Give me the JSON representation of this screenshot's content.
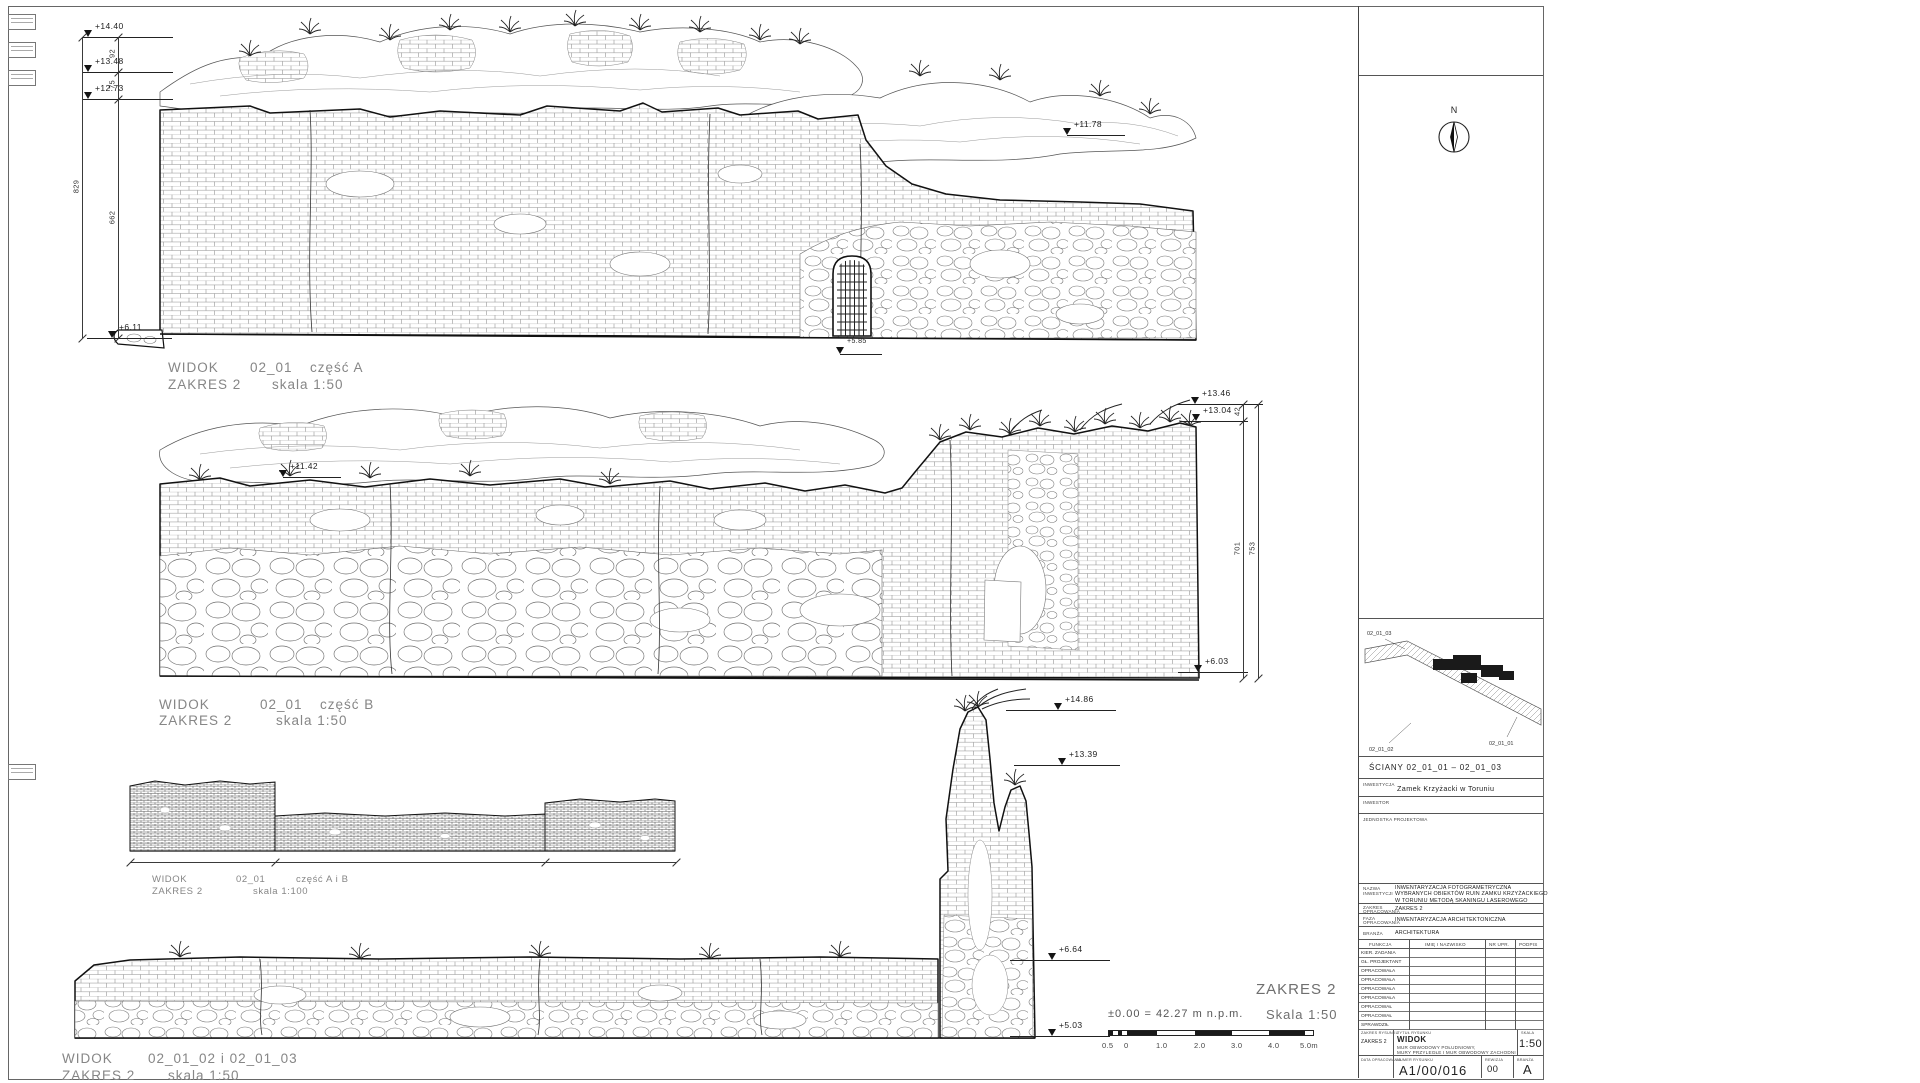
{
  "colors": {
    "ink": "#1f1f1f",
    "caption": "#868686",
    "dim": "#333333"
  },
  "captions": {
    "a": {
      "word": "WIDOK",
      "code": "02_01",
      "part": "część A",
      "zakres": "ZAKRES 2",
      "scale": "skala 1:50"
    },
    "b": {
      "word": "WIDOK",
      "code": "02_01",
      "part": "część B",
      "zakres": "ZAKRES 2",
      "scale": "skala 1:50"
    },
    "ab": {
      "word": "WIDOK",
      "code": "02_01",
      "part": "część A i B",
      "zakres": "ZAKRES 2",
      "scale": "skala 1:100"
    },
    "bottom": {
      "word": "WIDOK",
      "code": "02_01_02 i 02_01_03",
      "zakres": "ZAKRES 2",
      "scale": "skala 1:50"
    }
  },
  "markers": [
    {
      "label": "+14.40",
      "x": 88,
      "y": 37,
      "tail": 6,
      "len": 85
    },
    {
      "label": "+13.48",
      "x": 88,
      "y": 72,
      "tail": 6,
      "len": 85
    },
    {
      "label": "+12.73",
      "x": 88,
      "y": 99,
      "tail": 6,
      "len": 85
    },
    {
      "label": "+6.11",
      "x": 112,
      "y": 338,
      "tail": 25,
      "len": 60
    },
    {
      "label": "+11.78",
      "x": 1067,
      "y": 135,
      "tail": 0,
      "len": 58
    },
    {
      "label": "+5.85",
      "x": 840,
      "y": 354,
      "tail": 0,
      "len": 42,
      "fs": 7
    },
    {
      "label": "+11.42",
      "x": 283,
      "y": 477,
      "tail": 0,
      "len": 58
    },
    {
      "label": "+13.46",
      "x": 1195,
      "y": 404,
      "tail": 18,
      "len": 68
    },
    {
      "label": "+13.04",
      "x": 1196,
      "y": 421,
      "tail": 16,
      "len": 52
    },
    {
      "label": "+6.03",
      "x": 1198,
      "y": 672,
      "tail": 20,
      "len": 50
    },
    {
      "label": "+14.86",
      "x": 1058,
      "y": 710,
      "tail": 52,
      "len": 58
    },
    {
      "label": "+13.39",
      "x": 1062,
      "y": 765,
      "tail": 48,
      "len": 58
    },
    {
      "label": "+6.64",
      "x": 1052,
      "y": 960,
      "tail": 42,
      "len": 58
    },
    {
      "label": "+5.03",
      "x": 1052,
      "y": 1036,
      "tail": 42,
      "len": 58
    }
  ],
  "dims_v": [
    {
      "x": 82,
      "y1": 37,
      "y2": 338,
      "ticks": [
        37,
        338
      ],
      "labels": [
        {
          "t": "829",
          "y": 187
        }
      ]
    },
    {
      "x": 118,
      "y1": 37,
      "y2": 338,
      "ticks": [
        37,
        72,
        99,
        338
      ],
      "labels": [
        {
          "t": "92",
          "y": 54
        },
        {
          "t": "75",
          "y": 85
        },
        {
          "t": "662",
          "y": 218
        }
      ]
    },
    {
      "x": 1243,
      "y1": 404,
      "y2": 678,
      "ticks": [
        404,
        421,
        678
      ],
      "labels": [
        {
          "t": "42",
          "y": 412
        },
        {
          "t": "701",
          "y": 549
        }
      ]
    },
    {
      "x": 1258,
      "y1": 404,
      "y2": 678,
      "ticks": [
        404,
        678
      ],
      "labels": [
        {
          "t": "753",
          "y": 549
        }
      ]
    }
  ],
  "dims_h": [
    {
      "y": 862,
      "x1": 130,
      "x2": 676,
      "ticks": [
        130,
        275,
        545,
        676
      ]
    }
  ],
  "legend": {
    "zakres": "ZAKRES 2",
    "datum": "±0.00 = 42.27 m n.p.m.",
    "scale": "Skala 1:50",
    "scalebar_labels": [
      {
        "t": "0.5",
        "x": 1102
      },
      {
        "t": "0",
        "x": 1124
      },
      {
        "t": "1.0",
        "x": 1156
      },
      {
        "t": "2.0",
        "x": 1194
      },
      {
        "t": "3.0",
        "x": 1231
      },
      {
        "t": "4.0",
        "x": 1268
      },
      {
        "t": "5.0m",
        "x": 1300
      }
    ]
  },
  "titleblock": {
    "compass_n": "N",
    "plan": {
      "caption": "ŚCIANY 02_01_01 – 02_01_03",
      "labels": [
        {
          "t": "02_01_03"
        },
        {
          "t": "02_01_02"
        },
        {
          "t": "02_01_01"
        }
      ]
    },
    "inwestycja_label": "INWESTYCJA",
    "inwestycja": "Zamek Krzyżacki w Toruniu",
    "inwestor_label": "INWESTOR",
    "jednostka_label": "JEDNOSTKA PROJEKTOWA",
    "nazwa_label1": "NAZWA",
    "nazwa_label2": "INWESTYCJI",
    "nazwa_line1": "INWENTARYZACJA FOTOGRAMETRYCZNA",
    "nazwa_line2": "WYBRANYCH OBIEKTÓW RUIN ZAMKU KRZYŻACKIEGO",
    "nazwa_line3": "W TORUNIU METODĄ SKANINGU LASEROWEGO",
    "zakres_label1": "ZAKRES",
    "zakres_label2": "OPRACOWANIA",
    "zakres_value": "ZAKRES 2",
    "faza_label1": "FAZA",
    "faza_label2": "OPRACOWANIA",
    "faza_value": "INWENTARYZACJA ARCHITEKTONICZNA",
    "branza_label": "BRANŻA",
    "branza_value": "ARCHITEKTURA",
    "personnel_headers": [
      "FUNKCJA",
      "IMIĘ I NAZWISKO",
      "NR UPR.",
      "PODPIS"
    ],
    "personnel_rows": [
      "KIER. ZADANIA",
      "GŁ. PROJEKTANT",
      "OPRACOWAŁA",
      "OPRACOWAŁA",
      "OPRACOWAŁA",
      "OPRACOWAŁA",
      "OPRACOWAŁ",
      "OPRACOWAŁ",
      "SPRAWDZIŁ"
    ],
    "strip": {
      "zakres_label": "ZAKRES RYSUNKU",
      "zakres": "ZAKRES 2",
      "title_label": "TYTUŁ RYSUNKU",
      "title": "WIDOK",
      "subtitle1": "MUR OBWODOWY POŁUDNIOWY,",
      "subtitle2": "MURY PRZYLEGŁE I MUR OBWODOWY ZACHODNI",
      "scale_label": "SKALA",
      "scale": "1:50",
      "date_label": "DATA OPRACOWANIA",
      "number_label": "NUMER RYSUNKU",
      "number": "A1/00/016",
      "rev_label": "REWIZJA",
      "rev": "00",
      "branza_label": "BRANŻA",
      "branza": "A"
    }
  }
}
